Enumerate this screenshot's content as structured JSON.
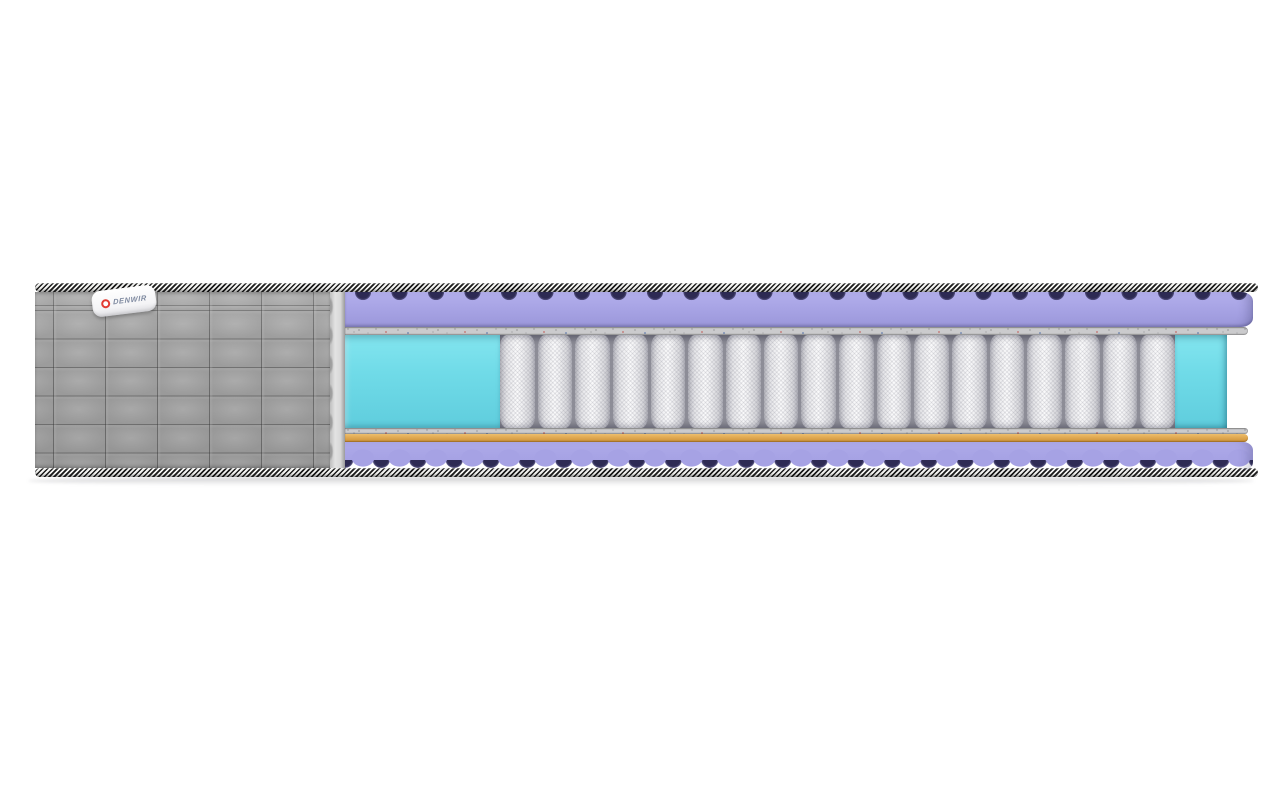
{
  "page": {
    "background_color": "#ffffff"
  },
  "label": {
    "brand": "DENWIR",
    "logo_color": "#e23b33",
    "text_color": "#7f8aa0"
  },
  "mattress": {
    "description_names": {
      "cover": "quilted-cover",
      "piping": "striped-braid-piping",
      "top_layer": "wave-foam-top",
      "felt": "felt-pad",
      "edge_support": "edge-support-foam",
      "springs": "pocket-spring-block",
      "coir": "coir-sheet",
      "bottom_layer": "wave-foam-bottom"
    },
    "springs": {
      "count": 18,
      "color": "#f5f5f7",
      "gap_color": "#8d8d97"
    },
    "colors": {
      "cover_gray": "#9e9e9e",
      "cover_cut_face": "#d8d8d8",
      "braid_black": "#1b1b1b",
      "braid_white": "#f3f3f1",
      "foam_lavender": "#a8a4e5",
      "foam_wave_shadow": "#2e2b54",
      "felt_gray": "#cbcbcd",
      "edge_support_cyan": "#70dbe8",
      "coir_orange": "#dda44c"
    }
  }
}
